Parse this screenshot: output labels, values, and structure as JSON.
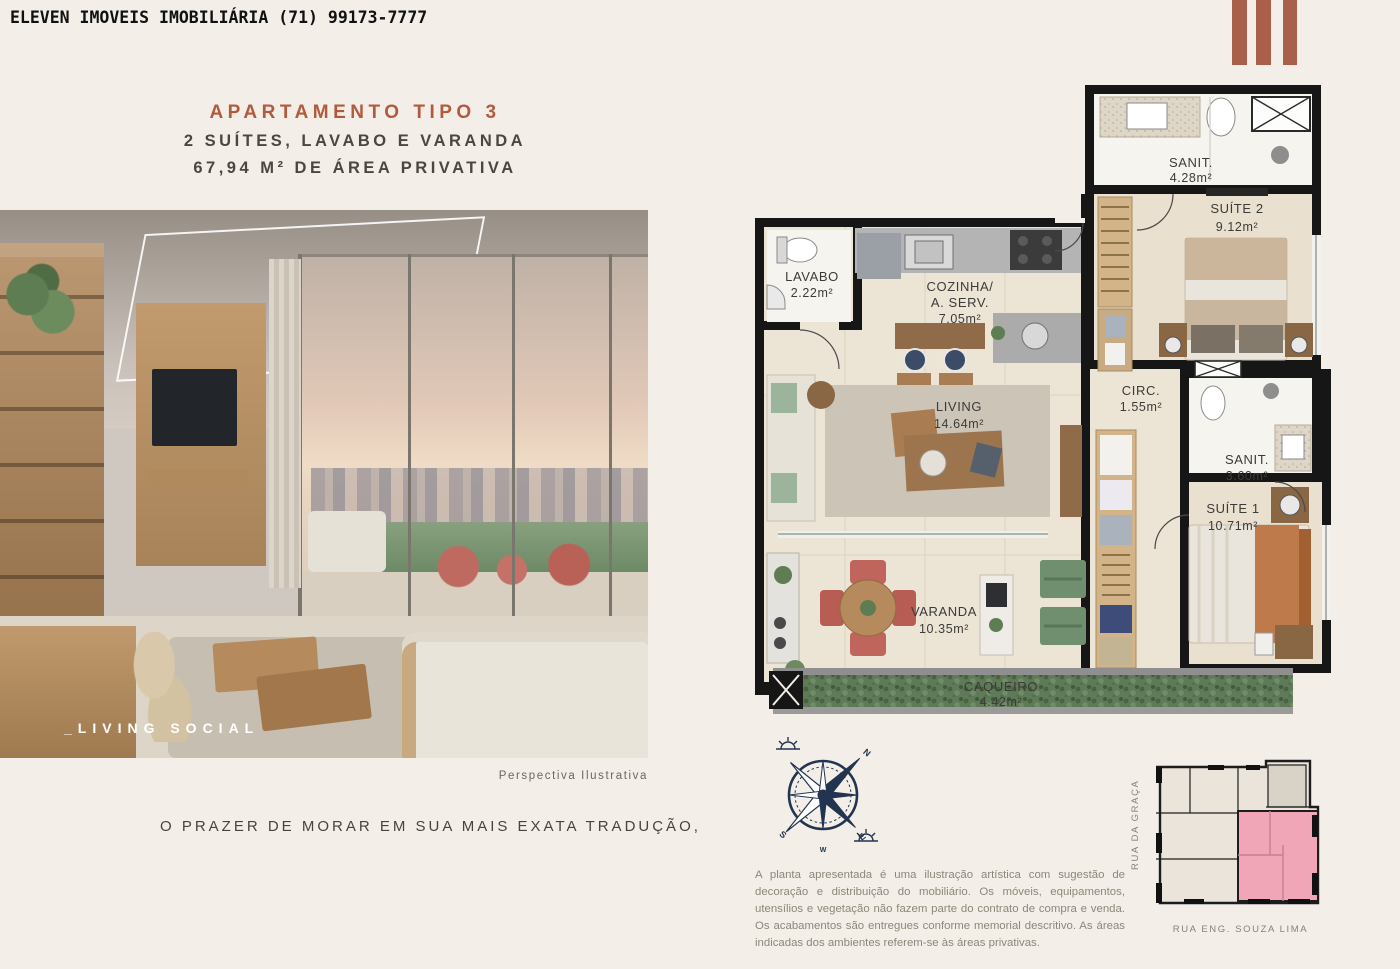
{
  "header": {
    "agency": "ELEVEN IMOVEIS IMOBILIÁRIA (71) 99173-7777"
  },
  "brand": {
    "accent": "#a8604a"
  },
  "title": {
    "line1": "APARTAMENTO TIPO 3",
    "line2": "2 SUÍTES, LAVABO E VARANDA",
    "line3": "67,94 M² DE ÁREA PRIVATIVA",
    "accent": "#b25a3c"
  },
  "photo": {
    "label": "_LIVING SOCIAL",
    "caption": "Perspectiva Ilustrativa"
  },
  "tagline": "O PRAZER DE MORAR EM SUA MAIS EXATA TRADUÇÃO,",
  "plan": {
    "rooms": [
      {
        "name": "LAVABO",
        "area": "2.22m²"
      },
      {
        "name": "COZINHA/",
        "name2": "A. SERV.",
        "area": "7.05m²"
      },
      {
        "name": "SANIT.",
        "area": "4.28m²"
      },
      {
        "name": "SUÍTE 2",
        "area": "9.12m²"
      },
      {
        "name": "LIVING",
        "area": "14.64m²"
      },
      {
        "name": "CIRC.",
        "area": "1.55m²"
      },
      {
        "name": "SANIT.",
        "area": "3.60m²"
      },
      {
        "name": "SUÍTE 1",
        "area": "10.71m²"
      },
      {
        "name": "VARANDA",
        "area": "10.35m²"
      },
      {
        "name": "CAQUEIRO",
        "area": "4.42m²"
      }
    ]
  },
  "compass": {
    "n": "N",
    "e": "E",
    "s": "S",
    "w": "W",
    "color": "#22344f"
  },
  "disclaimer": "A planta apresentada é uma ilustração artística com sugestão de decoração e distribuição do mobiliário. Os móveis, equipamentos, utensílios e vegetação não fazem parte do contrato de compra e venda. Os acabamentos são entregues conforme memorial descritivo. As áreas indicadas dos ambientes referem-se às áreas privativas.",
  "keyplan": {
    "street_left": "RUA DA GRAÇA",
    "street_bottom": "RUA ENG. SOUZA LIMA",
    "highlight": "#f0a6b7"
  }
}
